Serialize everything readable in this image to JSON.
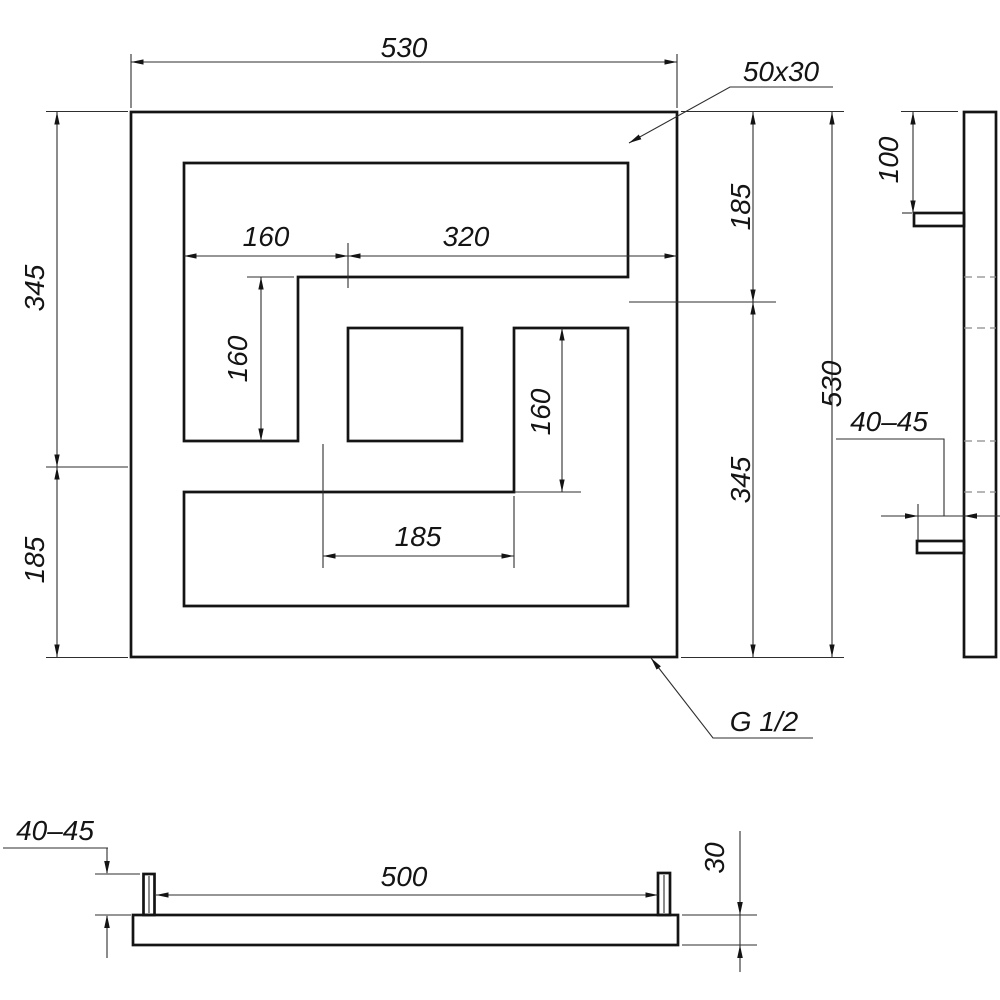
{
  "front_view": {
    "dim_width_top": "530",
    "dim_profile": "50x30",
    "dim_160_upper": "160",
    "dim_320_upper": "320",
    "dim_160_left": "160",
    "dim_160_right": "160",
    "dim_185_middle": "185",
    "dim_345_left": "345",
    "dim_185_left": "185",
    "dim_185_right": "185",
    "dim_345_right": "345",
    "dim_530_right": "530",
    "thread_label": "G 1/2"
  },
  "side_view": {
    "dim_100": "100",
    "dim_gap": "40–45"
  },
  "bottom_view": {
    "dim_gap": "40–45",
    "dim_500": "500",
    "dim_30": "30"
  },
  "colors": {
    "outline": "#141414",
    "dimension_lines": "#2e2e2e",
    "hidden_lines": "#8a8a8a",
    "background": "#ffffff"
  }
}
